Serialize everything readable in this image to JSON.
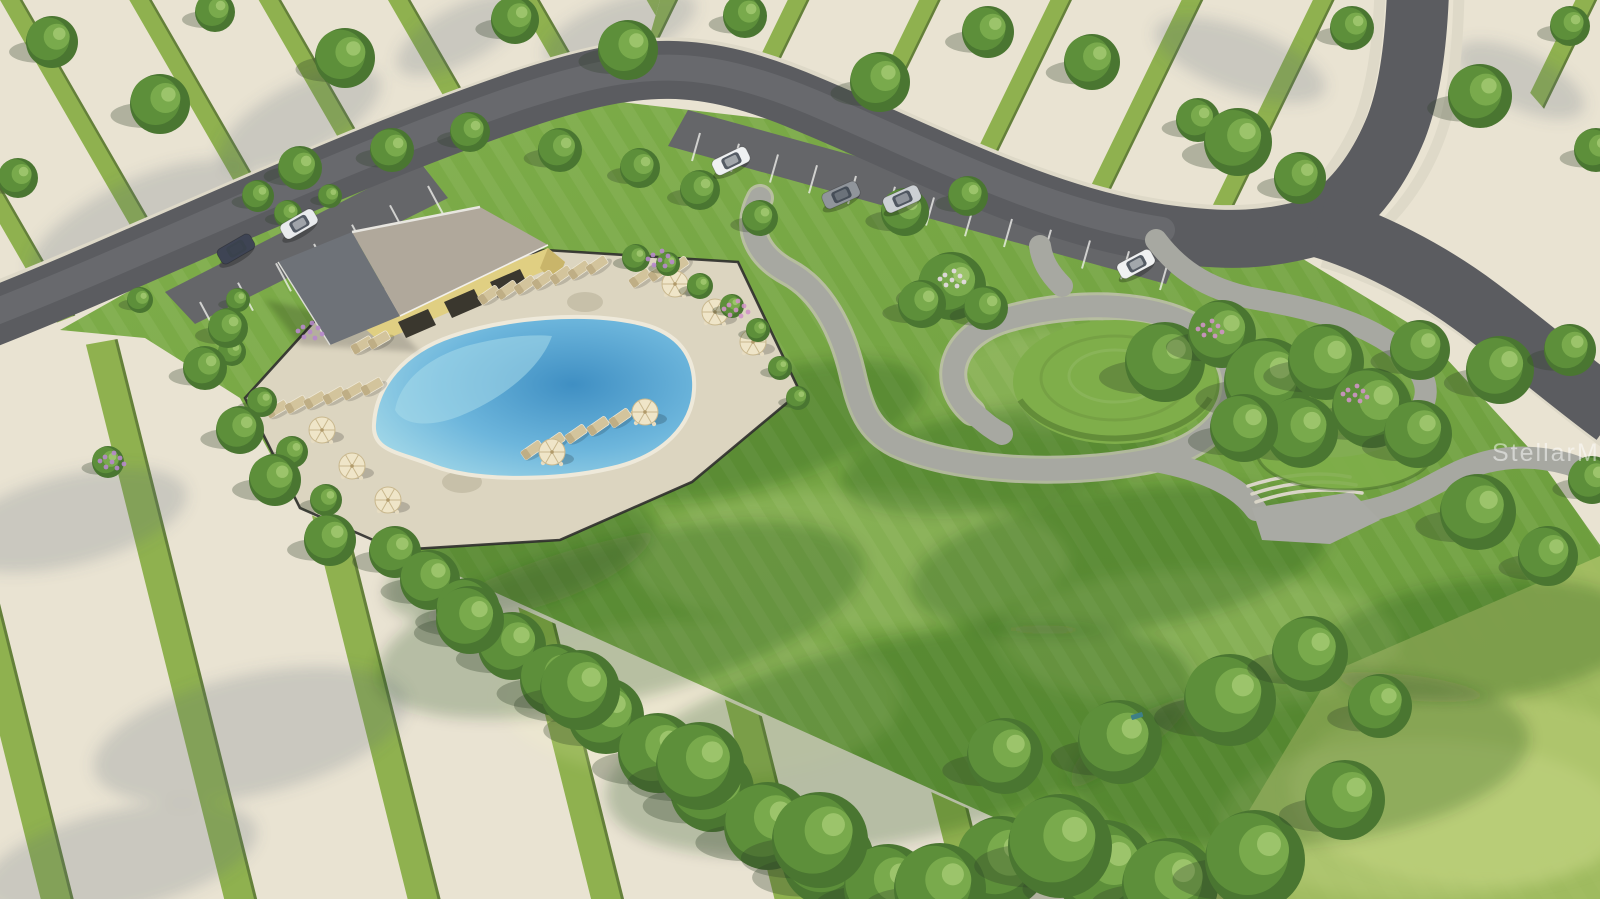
{
  "image": {
    "alt": "Aerial 3D rendering of a community amenity center: yellow clubhouse with gray gable roof, fenced paver pool deck with free-form blue pool, tan lounge chairs and cream umbrellas, large green event lawn with winding gray paths, terraced steps, curved street with angled parking and cars, and surrounding cleared home-site pads separated by grass strips"
  },
  "watermark": {
    "text": "StellarMLS",
    "color": "rgba(255,255,255,0.5)"
  },
  "palette": {
    "pad": "#e9e3d2",
    "padStripeGrass": "#8fb14f",
    "padStripeEdge": "#64803a",
    "asphalt": "#5b5c60",
    "asphaltLight": "#737478",
    "apron": "#656669",
    "sidewalk": "#ded9c8",
    "stall": "#f5f5f2",
    "lawn1": "#7fae4a",
    "lawn2": "#699a3b",
    "lawnPale": "#a9c166",
    "lawnPaler": "#bccf78",
    "path": "#a7a8a1",
    "pathEdge": "#c6c3b5",
    "plaza": "#a9aaa4",
    "step": "#d9d5c7",
    "deck": "#dcd5c0",
    "deckShade": "#c7c0a9",
    "fence": "#2e2d2b",
    "poolShallow": "#a7dbe9",
    "poolMid": "#6db6dc",
    "poolDeep": "#3f8fc3",
    "poolEdge": "#eee9da",
    "roofLight": "#b0a89b",
    "roofDark": "#6e7278",
    "roofRidge": "#e8e6e0",
    "wall": "#e0cf82",
    "wallShade": "#c9b56a",
    "opening": "#3a372e",
    "umbrella": "#efe5c8",
    "umbrellaRib": "#c9b88e",
    "lounger": "#d3c49c",
    "loungerBack": "#bfae85",
    "table": "#f1ece0",
    "treeDark": "#4a7631",
    "treeMid": "#5d8f3a",
    "treeLight": "#79aa4c",
    "treeHi": "#9cc46b",
    "shrubDark": "#3f6a2c",
    "flowerPink": "#cf93c6",
    "flowerPurple": "#b788cc",
    "flowerWhite": "#e7dce6",
    "benchTeal": "#3e7f86"
  },
  "objects": {
    "trees": [
      [
        52,
        42,
        26
      ],
      [
        160,
        104,
        30
      ],
      [
        18,
        178,
        20
      ],
      [
        215,
        12,
        20
      ],
      [
        345,
        58,
        30
      ],
      [
        515,
        20,
        24
      ],
      [
        628,
        50,
        30
      ],
      [
        745,
        16,
        22
      ],
      [
        880,
        82,
        30
      ],
      [
        988,
        32,
        26
      ],
      [
        1092,
        62,
        28
      ],
      [
        1198,
        120,
        22
      ],
      [
        1238,
        142,
        34
      ],
      [
        1300,
        178,
        26
      ],
      [
        1352,
        28,
        22
      ],
      [
        1480,
        96,
        32
      ],
      [
        1570,
        26,
        20
      ],
      [
        1596,
        150,
        22
      ],
      [
        1420,
        350,
        30
      ],
      [
        1500,
        370,
        34
      ],
      [
        1570,
        350,
        26
      ],
      [
        1478,
        512,
        38
      ],
      [
        1548,
        556,
        30
      ],
      [
        1592,
        480,
        24
      ],
      [
        228,
        328,
        20
      ],
      [
        205,
        368,
        22
      ],
      [
        240,
        430,
        24
      ],
      [
        275,
        480,
        26
      ],
      [
        330,
        540,
        26
      ],
      [
        300,
        168,
        22
      ],
      [
        392,
        150,
        22
      ],
      [
        470,
        132,
        20
      ],
      [
        560,
        150,
        22
      ],
      [
        640,
        168,
        20
      ],
      [
        700,
        190,
        20
      ],
      [
        760,
        218,
        18
      ],
      [
        905,
        212,
        24
      ],
      [
        968,
        196,
        20
      ],
      [
        470,
        620,
        34
      ],
      [
        580,
        690,
        40
      ],
      [
        700,
        766,
        44
      ],
      [
        820,
        840,
        48
      ],
      [
        940,
        889,
        46
      ],
      [
        1060,
        846,
        52
      ],
      [
        1170,
        886,
        48
      ],
      [
        1005,
        756,
        38
      ],
      [
        1120,
        742,
        42
      ],
      [
        1230,
        700,
        46
      ],
      [
        1310,
        654,
        38
      ],
      [
        1380,
        706,
        32
      ],
      [
        1255,
        860,
        50
      ],
      [
        1345,
        800,
        40
      ]
    ],
    "hedge": [
      [
        395,
        552,
        26
      ],
      [
        430,
        580,
        30
      ],
      [
        468,
        610,
        32
      ],
      [
        512,
        646,
        34
      ],
      [
        556,
        680,
        36
      ],
      [
        606,
        716,
        38
      ],
      [
        658,
        753,
        40
      ],
      [
        712,
        790,
        42
      ],
      [
        768,
        826,
        44
      ],
      [
        828,
        860,
        46
      ],
      [
        888,
        888,
        44
      ],
      [
        948,
        899,
        42
      ],
      [
        1002,
        862,
        46
      ],
      [
        1105,
        870,
        50
      ]
    ],
    "shrubs": [
      [
        636,
        258,
        14
      ],
      [
        668,
        264,
        12
      ],
      [
        700,
        286,
        13
      ],
      [
        732,
        306,
        12
      ],
      [
        758,
        330,
        12
      ],
      [
        780,
        368,
        12
      ],
      [
        798,
        398,
        12
      ],
      [
        232,
        352,
        14
      ],
      [
        262,
        402,
        15
      ],
      [
        292,
        452,
        16
      ],
      [
        326,
        500,
        16
      ],
      [
        238,
        300,
        12
      ],
      [
        258,
        196,
        16
      ],
      [
        288,
        214,
        14
      ],
      [
        330,
        196,
        12
      ],
      [
        108,
        462,
        16
      ],
      [
        140,
        300,
        13
      ],
      [
        1165,
        362,
        40
      ],
      [
        1222,
        334,
        34
      ],
      [
        1268,
        382,
        44
      ],
      [
        1326,
        362,
        38
      ],
      [
        1372,
        408,
        40
      ],
      [
        1418,
        434,
        34
      ],
      [
        1302,
        432,
        36
      ],
      [
        1244,
        428,
        34
      ],
      [
        952,
        286,
        34
      ],
      [
        922,
        304,
        24
      ],
      [
        986,
        308,
        22
      ]
    ],
    "flowers": [
      {
        "x": 952,
        "y": 280,
        "c": "flowerWhite"
      },
      {
        "x": 1210,
        "y": 330,
        "c": "flowerPink"
      },
      {
        "x": 1355,
        "y": 395,
        "c": "flowerPink"
      },
      {
        "x": 660,
        "y": 260,
        "c": "flowerPurple"
      },
      {
        "x": 112,
        "y": 462,
        "c": "flowerPurple"
      },
      {
        "x": 310,
        "y": 332,
        "c": "flowerPurple"
      },
      {
        "x": 736,
        "y": 310,
        "c": "flowerPink"
      }
    ],
    "cars": [
      {
        "x": 236,
        "y": 249,
        "a": -30,
        "c": "#3e4454"
      },
      {
        "x": 299,
        "y": 224,
        "a": -30,
        "c": "#e9ebed"
      },
      {
        "x": 731,
        "y": 161,
        "a": -26,
        "c": "#eff1f2"
      },
      {
        "x": 841,
        "y": 195,
        "a": -24,
        "c": "#90959b"
      },
      {
        "x": 902,
        "y": 199,
        "a": -24,
        "c": "#ccd0d4"
      },
      {
        "x": 1136,
        "y": 264,
        "a": -28,
        "c": "#f0f1f2"
      }
    ],
    "umbrellas": [
      {
        "x": 675,
        "y": 284
      },
      {
        "x": 715,
        "y": 312
      },
      {
        "x": 753,
        "y": 342
      },
      {
        "x": 645,
        "y": 412
      },
      {
        "x": 552,
        "y": 452
      },
      {
        "x": 322,
        "y": 430
      },
      {
        "x": 352,
        "y": 466
      },
      {
        "x": 388,
        "y": 500
      }
    ],
    "loungerRows": [
      {
        "x": 489,
        "y": 295,
        "dx": 18,
        "dy": -5,
        "n": 7,
        "a": -35
      },
      {
        "x": 640,
        "y": 278,
        "dx": 19,
        "dy": -6,
        "n": 3,
        "a": -35
      },
      {
        "x": 532,
        "y": 450,
        "dx": 22,
        "dy": -8,
        "n": 6,
        "a": -35
      },
      {
        "x": 277,
        "y": 409,
        "dx": 19,
        "dy": -4.5,
        "n": 6,
        "a": -30
      },
      {
        "x": 362,
        "y": 345,
        "dx": 17,
        "dy": -5,
        "n": 2,
        "a": -30
      }
    ],
    "stallLines": [
      {
        "x1": 200,
        "y1": 302,
        "x2": 428,
        "y2": 186,
        "n": 7,
        "dx": 15,
        "dy": 28
      },
      {
        "x1": 700,
        "y1": 133,
        "x2": 1168,
        "y2": 262,
        "n": 13,
        "dx": -8,
        "dy": 28
      }
    ],
    "lawnShadows": [
      [
        620,
        620,
        250,
        80,
        -14
      ],
      [
        900,
        740,
        300,
        100,
        -12
      ],
      [
        1120,
        560,
        210,
        70,
        -8
      ],
      [
        760,
        430,
        170,
        55,
        -16
      ],
      [
        1300,
        760,
        230,
        85,
        -6
      ],
      [
        1480,
        640,
        160,
        60,
        -6
      ],
      [
        520,
        560,
        140,
        50,
        -16
      ],
      [
        1000,
        460,
        160,
        50,
        -8
      ]
    ],
    "lawnLights": [
      [
        850,
        560,
        220,
        70
      ],
      [
        1200,
        640,
        200,
        70
      ],
      [
        1420,
        820,
        200,
        80
      ],
      [
        700,
        700,
        200,
        80
      ],
      [
        1060,
        380,
        120,
        50
      ]
    ],
    "padShadows": [
      [
        140,
        225,
        120,
        45,
        -25
      ],
      [
        300,
        120,
        90,
        35,
        -28
      ],
      [
        70,
        520,
        120,
        45,
        -14
      ],
      [
        250,
        735,
        160,
        60,
        -13
      ],
      [
        120,
        860,
        140,
        50,
        -13
      ],
      [
        620,
        30,
        80,
        30,
        -20
      ],
      [
        1240,
        60,
        90,
        32,
        20
      ],
      [
        1520,
        80,
        70,
        28,
        25
      ],
      [
        460,
        35,
        70,
        28,
        -28
      ]
    ],
    "lawnBench": {
      "x": 1137,
      "y": 716
    }
  }
}
